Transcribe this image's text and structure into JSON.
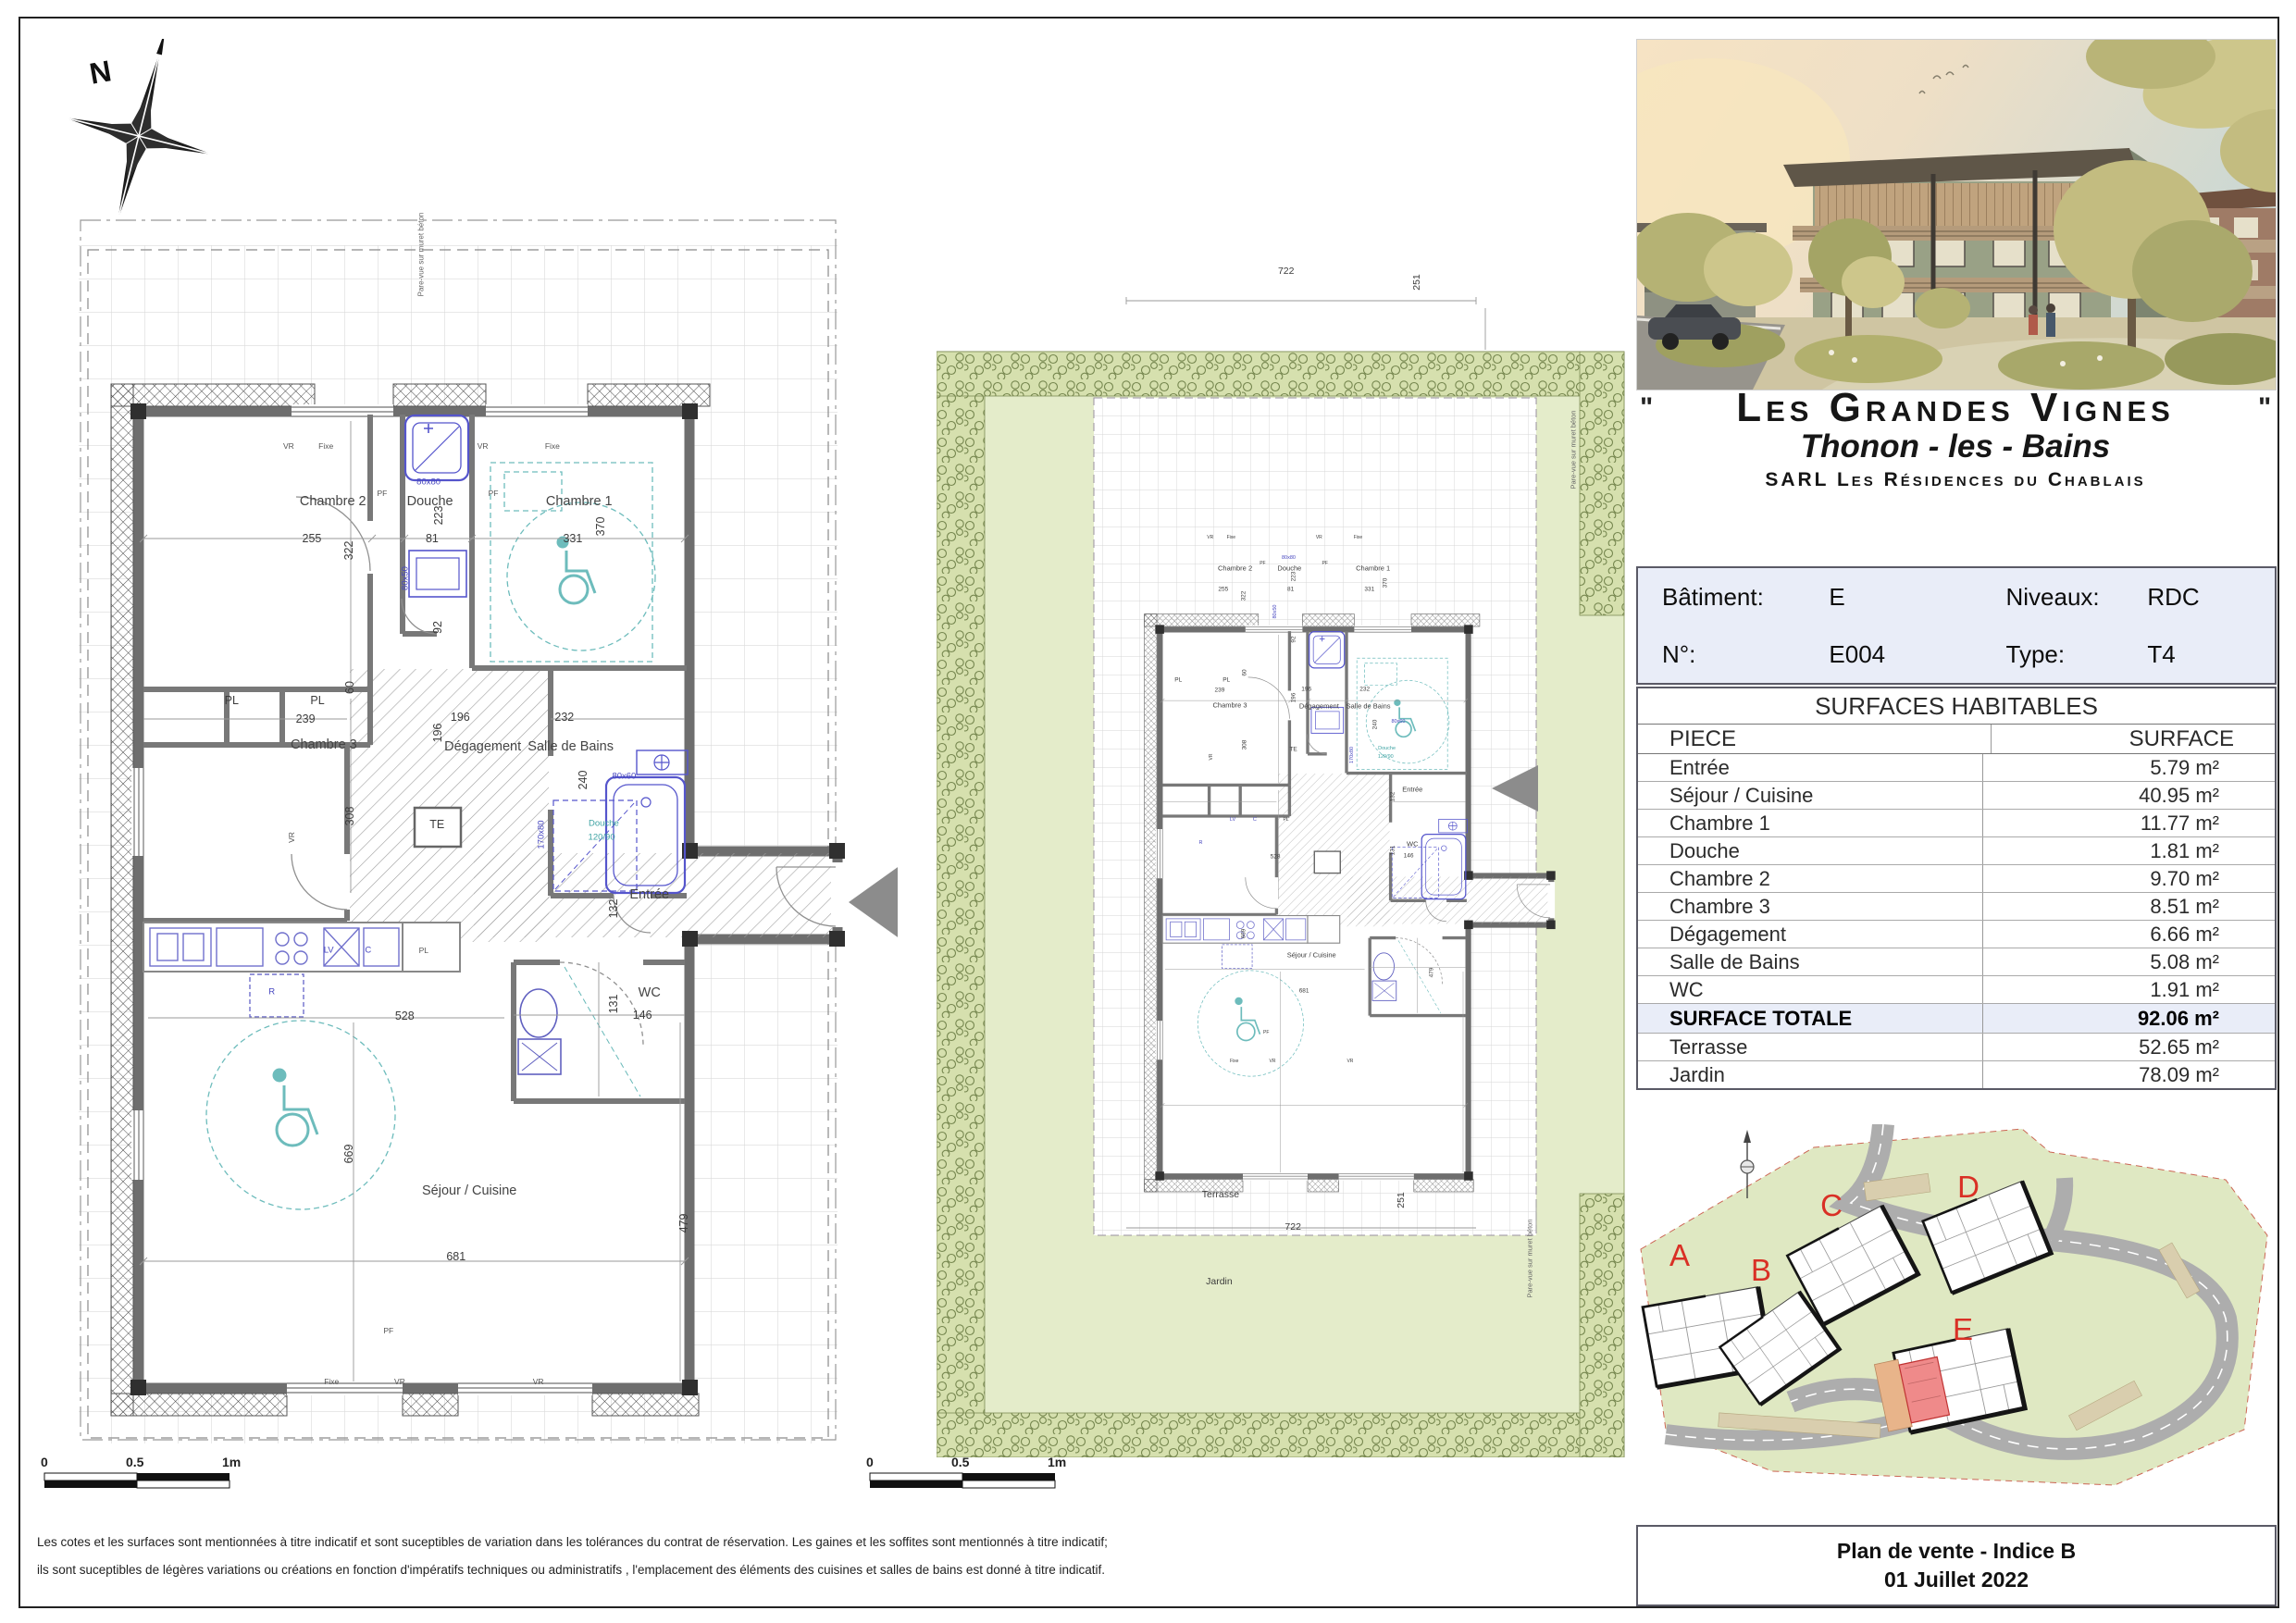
{
  "compass": {
    "label": "N"
  },
  "header": {
    "quote_open": "\"",
    "quote_close": "\"",
    "title": "Les Grandes Vignes",
    "subtitle": "Thonon - les - Bains",
    "company": "SARL Les Résidences du Chablais"
  },
  "unit_info": {
    "batiment_label": "Bâtiment:",
    "batiment_value": "E",
    "niveaux_label": "Niveaux:",
    "niveaux_value": "RDC",
    "numero_label": "N°:",
    "numero_value": "E004",
    "type_label": "Type:",
    "type_value": "T4"
  },
  "surfaces": {
    "title": "SURFACES HABITABLES",
    "col_piece": "PIECE",
    "col_surface": "SURFACE",
    "rows": [
      {
        "piece": "Entrée",
        "surface": "5.79 m²"
      },
      {
        "piece": "Séjour / Cuisine",
        "surface": "40.95 m²"
      },
      {
        "piece": "Chambre 1",
        "surface": "11.77 m²"
      },
      {
        "piece": "Douche",
        "surface": "1.81 m²"
      },
      {
        "piece": "Chambre 2",
        "surface": "9.70 m²"
      },
      {
        "piece": "Chambre 3",
        "surface": "8.51 m²"
      },
      {
        "piece": "Dégagement",
        "surface": "6.66 m²"
      },
      {
        "piece": "Salle de Bains",
        "surface": "5.08 m²"
      },
      {
        "piece": "WC",
        "surface": "1.91 m²"
      }
    ],
    "total_row": {
      "piece": "SURFACE TOTALE",
      "surface": "92.06 m²"
    },
    "extra_rows": [
      {
        "piece": "Terrasse",
        "surface": "52.65 m²"
      },
      {
        "piece": "Jardin",
        "surface": "78.09 m²"
      }
    ]
  },
  "siteplan": {
    "buildings": [
      "A",
      "B",
      "C",
      "D",
      "E"
    ]
  },
  "footer": {
    "line1": "Plan de vente - Indice B",
    "line2": "01 Juillet 2022"
  },
  "scalebar": {
    "zero": "0",
    "half": "0.5",
    "one": "1m"
  },
  "plans": {
    "apartment_labels": [
      {
        "t": "Chambre 2",
        "x": 27.6,
        "y": 9.2,
        "s": "r"
      },
      {
        "t": "255",
        "x": 24.6,
        "y": 13.0,
        "s": "d"
      },
      {
        "t": "322",
        "x": 29.9,
        "y": 14.2,
        "s": "d",
        "r": 1
      },
      {
        "t": "Douche",
        "x": 41.4,
        "y": 9.2,
        "s": "r"
      },
      {
        "t": "81",
        "x": 41.7,
        "y": 13.0,
        "s": "d"
      },
      {
        "t": "223",
        "x": 42.6,
        "y": 10.6,
        "s": "d",
        "r": 1
      },
      {
        "t": "80x80",
        "x": 41.2,
        "y": 7.2,
        "s": "b",
        "c": "b"
      },
      {
        "t": "Chambre 1",
        "x": 62.6,
        "y": 9.2,
        "s": "r"
      },
      {
        "t": "331",
        "x": 61.7,
        "y": 13.0,
        "s": "d"
      },
      {
        "t": "370",
        "x": 65.7,
        "y": 11.8,
        "s": "d",
        "r": 1
      },
      {
        "t": "VR",
        "x": 21.3,
        "y": 3.5,
        "s": "t"
      },
      {
        "t": "Fixe",
        "x": 26.6,
        "y": 3.5,
        "s": "t"
      },
      {
        "t": "VR",
        "x": 48.9,
        "y": 3.5,
        "s": "t"
      },
      {
        "t": "Fixe",
        "x": 58.8,
        "y": 3.5,
        "s": "t"
      },
      {
        "t": "PF",
        "x": 34.6,
        "y": 8.3,
        "s": "t"
      },
      {
        "t": "PF",
        "x": 50.4,
        "y": 8.3,
        "s": "t"
      },
      {
        "t": "PL",
        "x": 13.2,
        "y": 29.6,
        "s": "d"
      },
      {
        "t": "PL",
        "x": 25.4,
        "y": 29.6,
        "s": "d"
      },
      {
        "t": "239",
        "x": 23.7,
        "y": 31.5,
        "s": "d"
      },
      {
        "t": "60",
        "x": 30.0,
        "y": 28.2,
        "s": "d",
        "r": 1
      },
      {
        "t": "Chambre 3",
        "x": 26.3,
        "y": 34.1,
        "s": "r"
      },
      {
        "t": "308",
        "x": 30.0,
        "y": 41.4,
        "s": "d",
        "r": 1
      },
      {
        "t": "196",
        "x": 45.7,
        "y": 31.3,
        "s": "d"
      },
      {
        "t": "196",
        "x": 42.5,
        "y": 32.9,
        "s": "d",
        "r": 1
      },
      {
        "t": "Dégagement",
        "x": 48.9,
        "y": 34.3,
        "s": "r"
      },
      {
        "t": "92",
        "x": 42.5,
        "y": 22.1,
        "s": "d",
        "r": 1
      },
      {
        "t": "80x50",
        "x": 37.9,
        "y": 17.1,
        "s": "b",
        "c": "b",
        "r": 1
      },
      {
        "t": "Salle de Bains",
        "x": 61.4,
        "y": 34.3,
        "s": "r"
      },
      {
        "t": "232",
        "x": 60.5,
        "y": 31.3,
        "s": "d"
      },
      {
        "t": "240",
        "x": 63.2,
        "y": 37.7,
        "s": "d",
        "r": 1
      },
      {
        "t": "80x60",
        "x": 69.0,
        "y": 37.3,
        "s": "b",
        "c": "b"
      },
      {
        "t": "TE",
        "x": 42.4,
        "y": 42.3,
        "s": "d"
      },
      {
        "t": "Douche",
        "x": 66.1,
        "y": 42.2,
        "s": "b",
        "c": "t"
      },
      {
        "t": "120/90",
        "x": 65.8,
        "y": 43.6,
        "s": "b",
        "c": "t"
      },
      {
        "t": "170x80",
        "x": 57.2,
        "y": 43.3,
        "s": "b",
        "c": "b",
        "r": 1
      },
      {
        "t": "Entrée",
        "x": 72.6,
        "y": 49.5,
        "s": "r"
      },
      {
        "t": "132",
        "x": 67.5,
        "y": 50.9,
        "s": "d",
        "r": 1
      },
      {
        "t": "WC",
        "x": 72.6,
        "y": 59.5,
        "s": "r"
      },
      {
        "t": "131",
        "x": 67.5,
        "y": 60.7,
        "s": "d",
        "r": 1
      },
      {
        "t": "146",
        "x": 71.6,
        "y": 61.8,
        "s": "d"
      },
      {
        "t": "528",
        "x": 37.8,
        "y": 61.9,
        "s": "d"
      },
      {
        "t": "LV",
        "x": 27.0,
        "y": 55.2,
        "s": "b",
        "c": "b"
      },
      {
        "t": "C",
        "x": 32.6,
        "y": 55.2,
        "s": "b",
        "c": "b"
      },
      {
        "t": "PL",
        "x": 40.5,
        "y": 55.2,
        "s": "t"
      },
      {
        "t": "R",
        "x": 18.9,
        "y": 59.4,
        "s": "b",
        "c": "b"
      },
      {
        "t": "Séjour / Cuisine",
        "x": 47.0,
        "y": 79.8,
        "s": "r"
      },
      {
        "t": "669",
        "x": 29.9,
        "y": 76.0,
        "s": "d",
        "r": 1
      },
      {
        "t": "681",
        "x": 45.1,
        "y": 86.5,
        "s": "d"
      },
      {
        "t": "479",
        "x": 77.5,
        "y": 83.1,
        "s": "d",
        "r": 1
      },
      {
        "t": "PF",
        "x": 35.5,
        "y": 94.1,
        "s": "t"
      },
      {
        "t": "Fixe",
        "x": 27.4,
        "y": 99.3,
        "s": "t"
      },
      {
        "t": "VR",
        "x": 37.1,
        "y": 99.3,
        "s": "t"
      },
      {
        "t": "VR",
        "x": 56.8,
        "y": 99.3,
        "s": "t"
      },
      {
        "t": "VR",
        "x": 21.7,
        "y": 43.6,
        "s": "t",
        "r": 1
      }
    ],
    "large_extra": [
      {
        "t": "Pare-vue sur muret béton",
        "x": 41.8,
        "y": 3.4,
        "s": "t",
        "r": 1
      }
    ],
    "small_extra": [
      {
        "t": "722",
        "x": 50.7,
        "y": 4.7,
        "s": "d"
      },
      {
        "t": "251",
        "x": 69.6,
        "y": 5.6,
        "s": "d",
        "r": 1
      },
      {
        "t": "Pare-vue sur muret béton",
        "x": 92.4,
        "y": 19.0,
        "s": "t",
        "r": 1
      },
      {
        "t": "Terrasse",
        "x": 41.2,
        "y": 78.9,
        "s": "d"
      },
      {
        "t": "722",
        "x": 51.7,
        "y": 81.5,
        "s": "d"
      },
      {
        "t": "251",
        "x": 67.4,
        "y": 79.3,
        "s": "d",
        "r": 1
      },
      {
        "t": "Pare-vue sur muret béton",
        "x": 86.0,
        "y": 84.0,
        "s": "t",
        "r": 1
      },
      {
        "t": "Jardin",
        "x": 41.0,
        "y": 85.9,
        "s": "d"
      }
    ]
  }
}
